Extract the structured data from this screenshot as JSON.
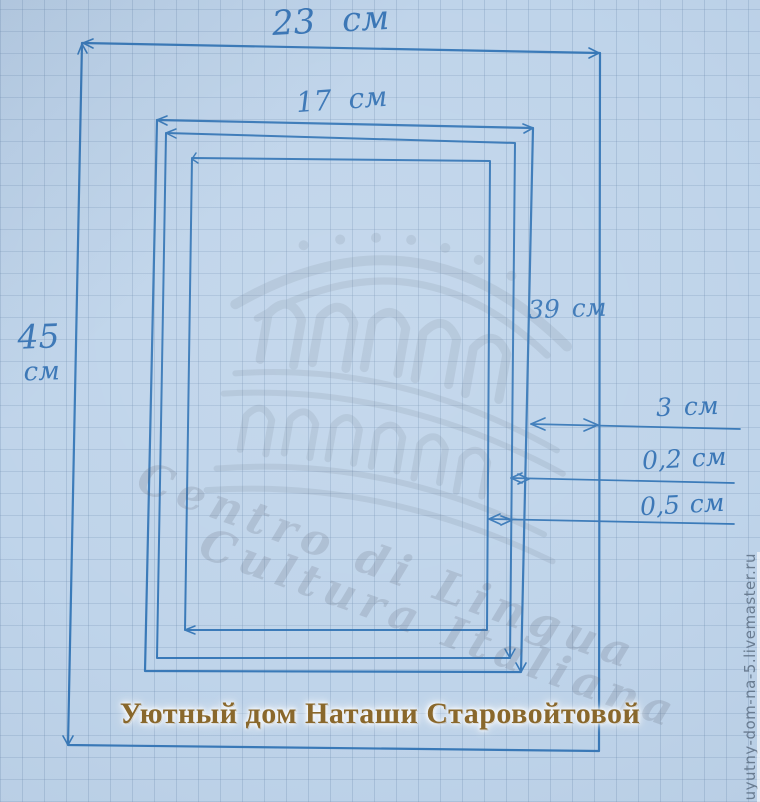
{
  "diagram": {
    "type": "hand-drawn frame sketch on graph paper",
    "labels": {
      "outer_width": "23 см",
      "inner_width": "17 см",
      "outer_height_value": "45",
      "outer_height_unit": "см",
      "inner_height": "39 см",
      "side_margin": "3 см",
      "gap_thin": "0,2 см",
      "gap_half": "0,5 см"
    },
    "measurements_cm": {
      "outer_rect": [
        23,
        45
      ],
      "inner_rect": [
        17,
        39
      ],
      "margin_between_rects": 3,
      "thin_offset": 0.2,
      "half_offset": 0.5
    }
  },
  "watermark": {
    "script_line1": "Centro di Lingua",
    "script_line2": "Cultura Italiana"
  },
  "branding": {
    "caption": "Уютный дом Наташи Старовойтовой",
    "site_url": "uyutny-dom-na-5.livemaster.ru"
  },
  "colors": {
    "paper": "#bfd4ea",
    "grid_line": "#6e8caf",
    "pen": "#2e72b4",
    "caption_gold": "#8a682b",
    "watermark_gray": "#5d6673",
    "url_text": "#5d6f83"
  }
}
